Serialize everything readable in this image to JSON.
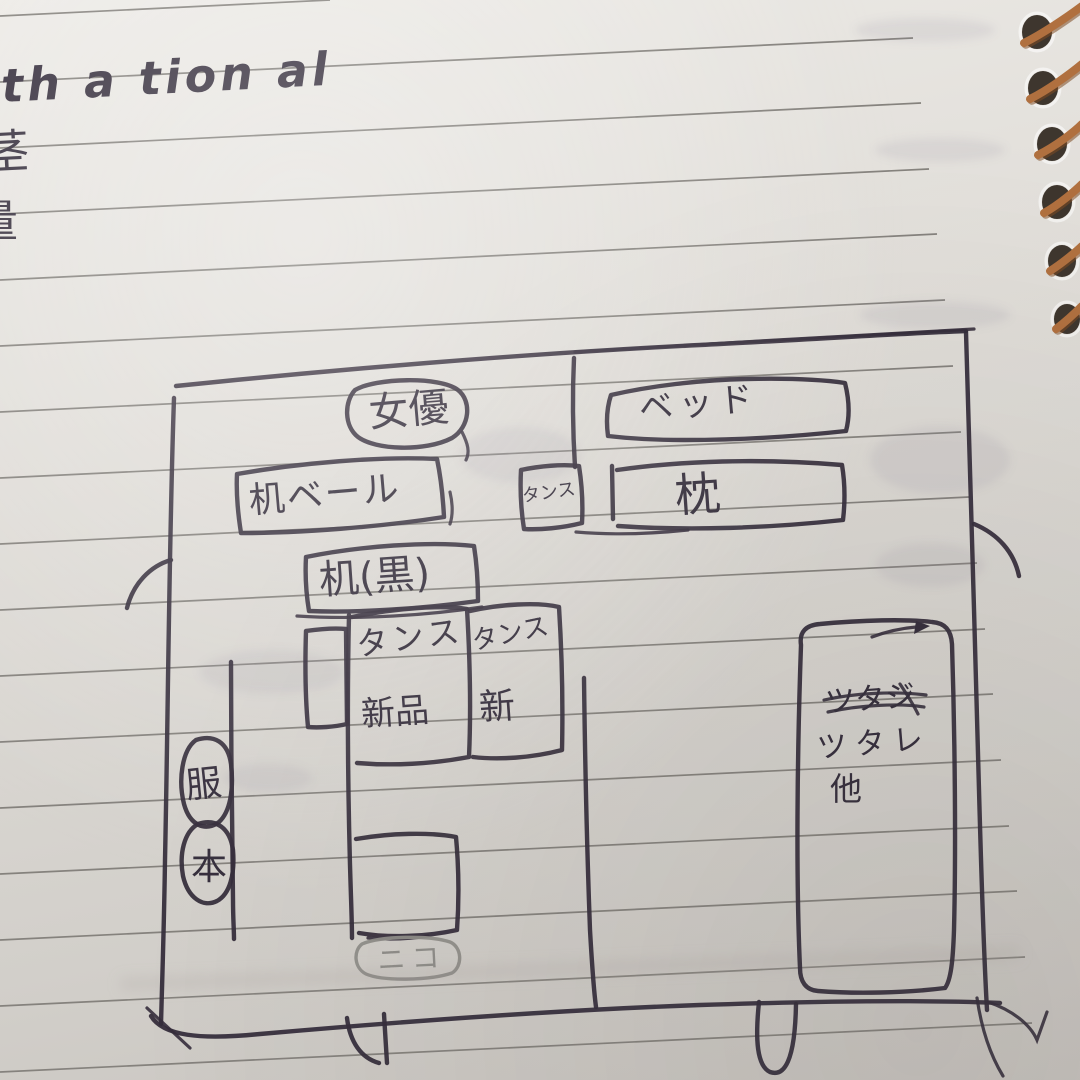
{
  "notebook": {
    "paper_color": "#dedbd6",
    "rule_color": "#85827d",
    "ink_color": "#352e3c",
    "pencil_color": "#8f8d89",
    "spiral_wire_color": "#b0703f",
    "spiral_hole_color": "#3e362e",
    "spiral_hole_count": 6
  },
  "handwriting": {
    "line1": "th a tion al",
    "fragment2": "茎",
    "fragment3": "量"
  },
  "diagram": {
    "oval_top": "女優",
    "bed": "ベッド",
    "pillow": "枕",
    "desk_beige": "机ベール",
    "desk_black": "机(黒)",
    "closet_small": "タンス",
    "closet_left_line1": "タンス",
    "closet_left_line2": "新品",
    "closet_right_line1": "タンス",
    "closet_right_line2": "新",
    "shelf_line1_crossed": "ツタジ",
    "shelf_line2": "ツタレ",
    "shelf_line3": "他",
    "wall_circle_top": "服",
    "wall_circle_bottom": "本",
    "door_note": "ニコ"
  }
}
